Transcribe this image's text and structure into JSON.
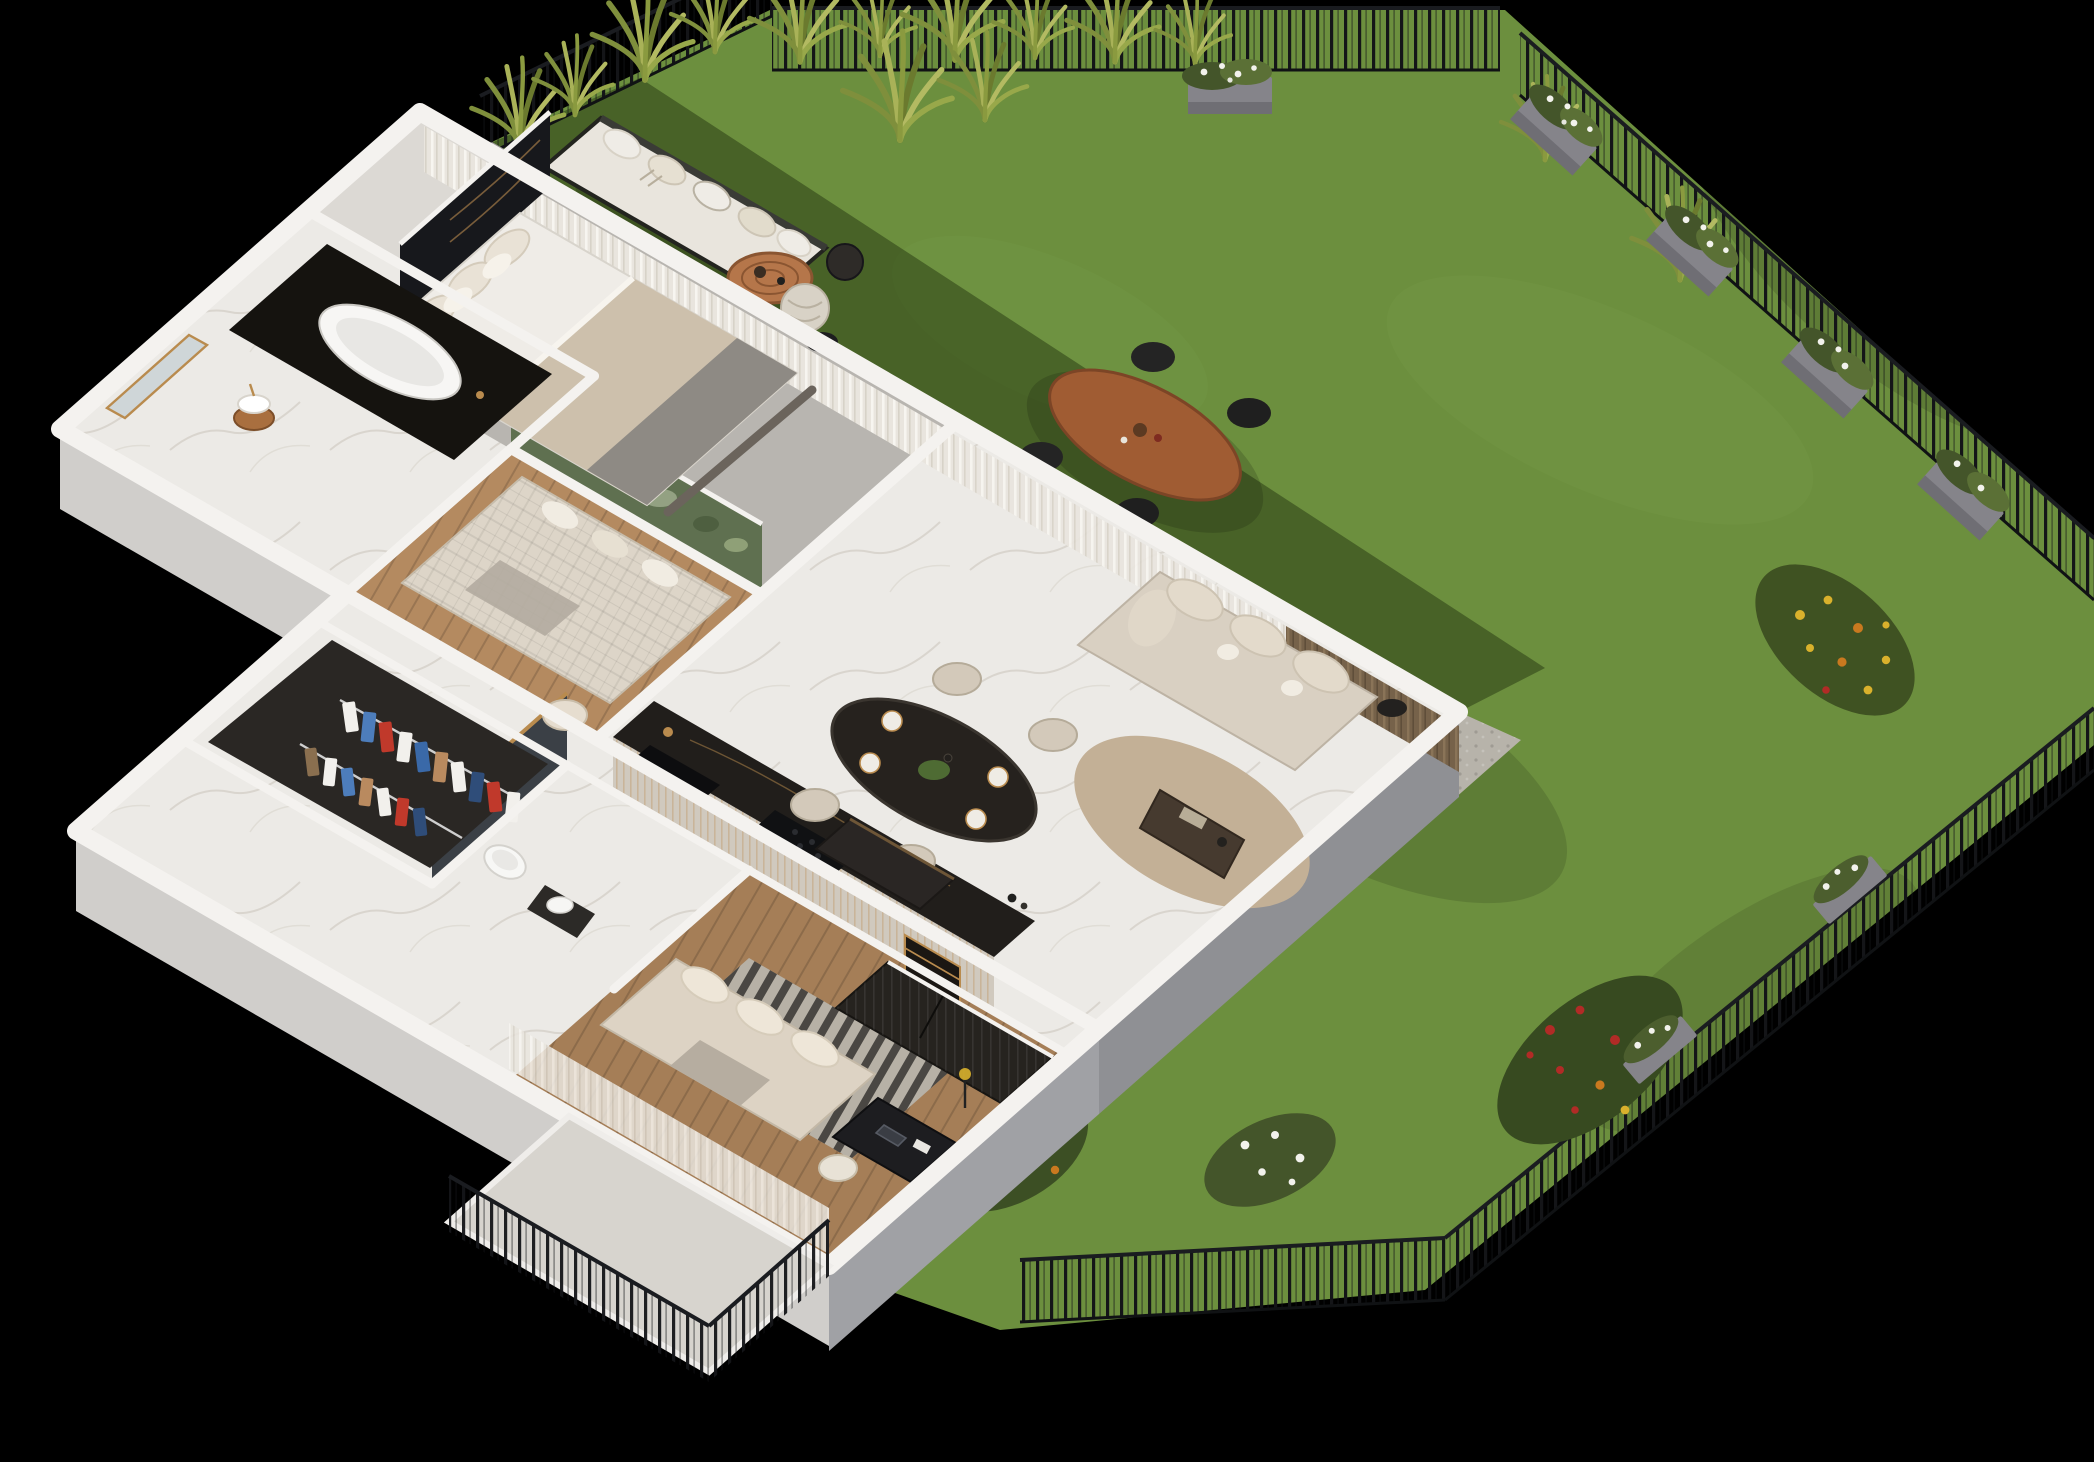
{
  "meta": {
    "type": "3d-isometric-apartment-floor-plan-render",
    "background": "#000000",
    "view": "cutaway axonometric top view, apartment with private fenced garden"
  },
  "palette": {
    "background": "#000000",
    "wallTop": "#f4f2ef",
    "wallFaceLight": "#dddbd8",
    "wallFaceMid": "#d0cecb",
    "wallFaceGrey": "#8f9094",
    "wallFaceGrey2": "#a0a1a5",
    "marbleFloor": "#eceae6",
    "carpetGrey": "#b8b5b0",
    "woodLounge": "#b48a60",
    "woodOffice": "#a57e57",
    "lawn": "#6c8f3e",
    "lawnShadow": "#24350f",
    "gravel": "#b7b3aa",
    "fenceDark": "#15171a",
    "counterDark": "#211e1b",
    "cabinetCream": "#d0c9be",
    "accentBlack": "#17181c",
    "jungleWall": "#5f7050",
    "tileDark": "#3b4046",
    "sofaBeige": "#d9d0c2",
    "bedWhite": "#efece7",
    "duvetBeige": "#cdc0ac",
    "duvetGrey": "#8e8a84",
    "diningTableDark": "#26221e",
    "chairCream": "#d3c9ba",
    "curtainSheer": "#e9e5de",
    "curtainBrown": "#76624a",
    "rugJute": "#c3b096",
    "rugOffice": "#b7b1a6",
    "terrace": "#d7d4ce",
    "outdoorWood": "#a05c33",
    "rattan": "#b5764a",
    "foliage": "#3f5222",
    "flowerRed": "#b12b26",
    "flowerYellow": "#d9b12c",
    "flowerOrange": "#c9791f",
    "flowerWhite": "#f2f2ec",
    "planterGrey": "#85848a",
    "gold": "#b98b4e",
    "copper": "#a96f3f",
    "toiletWhite": "#f7f7f5"
  },
  "apartment": {
    "rooms": [
      {
        "id": "master-bedroom",
        "furniture": [
          "double-bed",
          "pillows",
          "beige-grey-duvet",
          "black-marble-headboard-wall",
          "nightstands",
          "foot-bench",
          "sheer-curtains"
        ]
      },
      {
        "id": "bathroom",
        "furniture": [
          "freestanding-bathtub",
          "black-marble-tub-deck",
          "copper-pedestal-vessel-sink",
          "leaning-mirror"
        ]
      },
      {
        "id": "lounge-room",
        "furniture": [
          "quilted-sofa-bed",
          "botanical-wallpaper-wall",
          "cream-armchair",
          "wood-floor"
        ]
      },
      {
        "id": "kitchen-dining",
        "furniture": [
          "kitchen-counter-black-marble",
          "black-sink",
          "gold-faucet",
          "cooktop",
          "gold-wine-rack",
          "dining-table-black-marble",
          "dining-chairs",
          "place-settings",
          "centerpiece-plant"
        ]
      },
      {
        "id": "living-area",
        "furniture": [
          "curved-beige-sofa",
          "coffee-table",
          "jute-rug",
          "tv-console",
          "side-table",
          "sheer-and-brown-curtains"
        ]
      },
      {
        "id": "walk-in-wardrobe",
        "furniture": [
          "clothes-rails",
          "hanging-clothes"
        ]
      },
      {
        "id": "wc",
        "furniture": [
          "wall-hung-toilet",
          "dark-tile-accent-wall",
          "wood-shelf",
          "vessel-sink-cabinet"
        ]
      },
      {
        "id": "office-bedroom",
        "furniture": [
          "daybed-sofa",
          "slatted-dark-wardrobe",
          "desk",
          "laptop",
          "desk-chair",
          "striped-rug",
          "floor-lamp",
          "sheer-curtains"
        ]
      },
      {
        "id": "hallway",
        "furniture": [
          "marble-floor"
        ]
      },
      {
        "id": "entrance-terrace",
        "furniture": [
          "metal-railing"
        ]
      }
    ]
  },
  "garden": {
    "elements": [
      "lawn",
      "metal-picket-fence",
      "ornamental-grasses",
      "flower-planters",
      "white-flower-shrubs",
      "outdoor-sofa-bench",
      "round-rattan-coffee-table",
      "wicker-pouf",
      "sphere-lantern",
      "outdoor-dining-table",
      "outdoor-dining-chairs",
      "yellow-flower-bed",
      "red-rose-bed",
      "white-flower-bed",
      "gravel-border",
      "building-shadow"
    ]
  },
  "counts": {
    "indoor_dining_chairs": 4,
    "outdoor_dining_chairs": 4,
    "fence_planter_boxes": 5,
    "outdoor_sofa_back_cushions": 5,
    "wardrobe_garment_rows": 2
  }
}
